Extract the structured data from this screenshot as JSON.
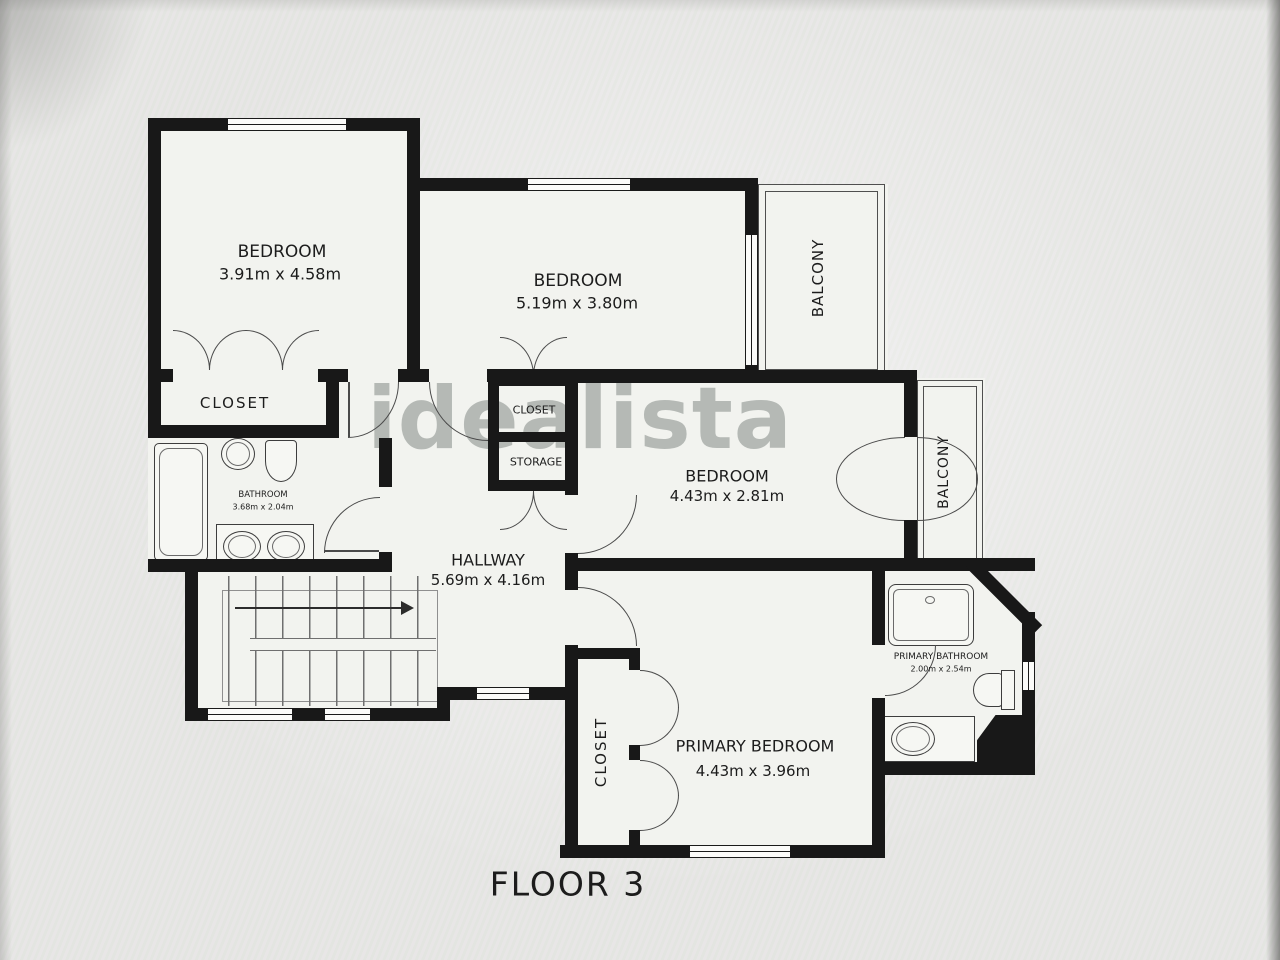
{
  "floor_plan": {
    "title": "FLOOR 3",
    "watermark": "idealista",
    "rooms": {
      "bedroom_top_left": {
        "name": "BEDROOM",
        "dims": "3.91m x 4.58m"
      },
      "bedroom_top_middle": {
        "name": "BEDROOM",
        "dims": "5.19m x 3.80m"
      },
      "bedroom_middle": {
        "name": "BEDROOM",
        "dims": "4.43m x 2.81m"
      },
      "primary_bedroom": {
        "name": "PRIMARY BEDROOM",
        "dims": "4.43m x 3.96m"
      },
      "hallway": {
        "name": "HALLWAY",
        "dims": "5.69m x 4.16m"
      },
      "bathroom": {
        "name": "BATHROOM",
        "dims": "3.68m x 2.04m"
      },
      "primary_bathroom": {
        "name": "PRIMARY BATHROOM",
        "dims": "2.00m x 2.54m"
      },
      "closet_bedroom1": {
        "name": "CLOSET"
      },
      "closet_hall": {
        "name": "CLOSET"
      },
      "storage": {
        "name": "STORAGE"
      },
      "closet_primary": {
        "name": "CLOSET"
      },
      "balcony_top": {
        "name": "BALCONY"
      },
      "balcony_right": {
        "name": "BALCONY"
      }
    }
  }
}
